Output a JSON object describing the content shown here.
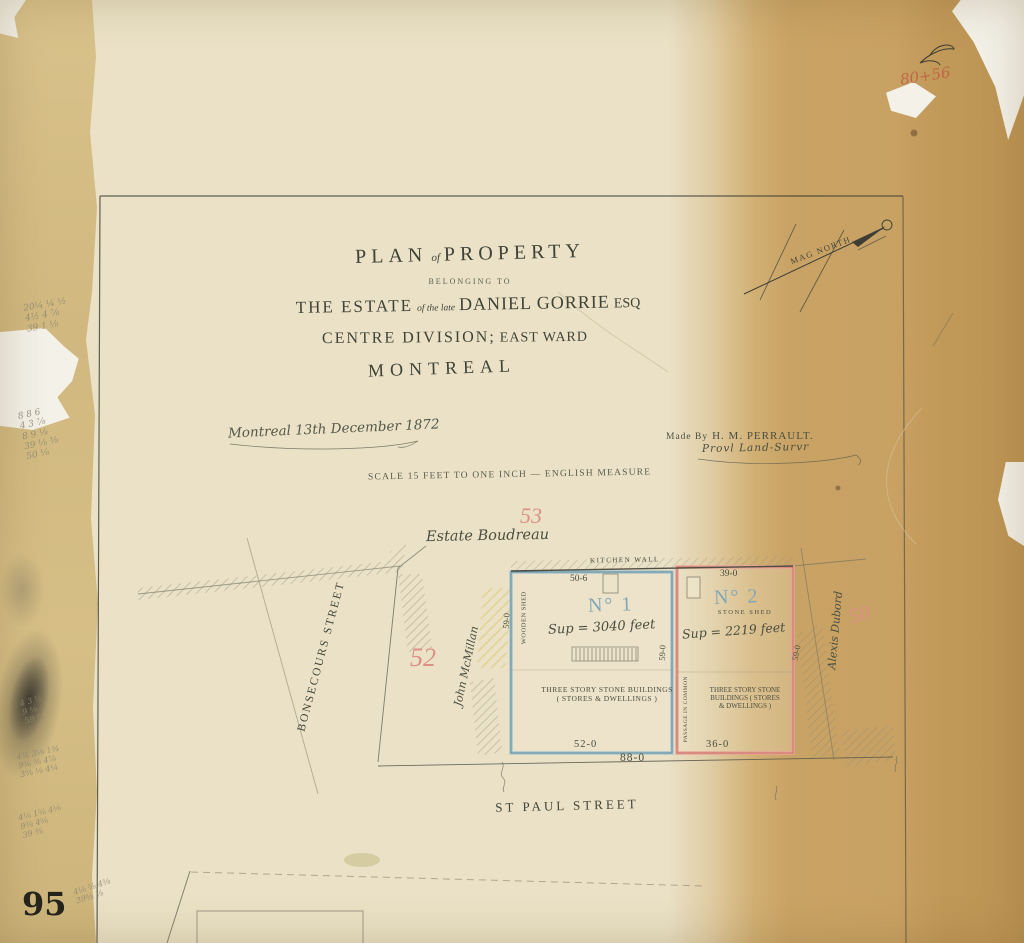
{
  "sheet": {
    "page_number": "95",
    "corner_notation": "80+56"
  },
  "colors": {
    "lot1_outline": "#92b7c0",
    "lot2_outline": "#e2988c",
    "cadastral_red": "#dc8f86",
    "ink": "#4a4e40",
    "paper_light": "#eae1c6",
    "paper_tan": "#c9a365"
  },
  "title_block": {
    "plan": "PLAN",
    "of": "of",
    "property": "PROPERTY",
    "belonging_to": "BELONGING TO",
    "the_estate": "THE ESTATE",
    "of_the_late": "of the late",
    "owner_name": "DANIEL GORRIE",
    "esq": "ESQ",
    "division": "CENTRE DIVISION;",
    "ward": "EAST WARD",
    "city": "MONTREAL"
  },
  "notes": {
    "date_line": "Montreal 13th December 1872",
    "made_by": "Made By",
    "surveyor_name": "H. M. PERRAULT.",
    "surveyor_title": "Provl Land-Survr",
    "scale_line": "SCALE 15 FEET TO ONE INCH — ENGLISH MEASURE",
    "north_label": "MAG NORTH"
  },
  "streets": {
    "west": "BONSECOURS STREET",
    "south": "ST PAUL STREET"
  },
  "neighbours": {
    "north_estate": "Estate Boudreau",
    "west_owner": "John McMillan",
    "east_owner": "Alexis Dubord"
  },
  "lot_numbers": {
    "north": "53",
    "west": "52",
    "east": "50"
  },
  "lot1": {
    "label": "N° 1",
    "area": "Sup = 3040 feet",
    "shed": "WOODEN SHED",
    "building": "THREE STORY STONE BUILDINGS\n( STORES & DWELLINGS )",
    "dim_top": "50-6",
    "dim_bottom": "52-0",
    "dim_side": "59-0"
  },
  "lot2": {
    "label": "N° 2",
    "sublabel": "STONE SHED",
    "area": "Sup = 2219 feet",
    "building": "THREE STORY STONE\nBUILDINGS ( STORES\n& DWELLINGS )",
    "dim_top": "39-0",
    "dim_bottom": "36-0",
    "dim_side": "59-0"
  },
  "boundary": {
    "kitchen_wall": "KITCHEN WALL",
    "passage": "PASSAGE IN COMMON",
    "dim_total_frontage": "88-0",
    "dim_mid": "59-0"
  },
  "pencil_notes": {
    "upper_left": "20¼ ¼ ½\n4½ 4 ⅞\n39 1 ⅛",
    "mid_left": "8 8 6\n4 3 ⅞\n8 9 ⅛\n39 ⅛ ⅜\n50 ⅛",
    "lower_left_a": "4 3 ½\n9 ⅛\n59 ½",
    "lower_left_b": "4¾ 3⅛ 1¾\n9⅜ ⅝ 4⅞\n3⅝ ⅛ 4¼",
    "lower_left_c": "4⅛ 1⅝ 4⅛\n9⅜ 4⅝\n39 ⅜",
    "bottom_left": "4⅛ ⅝ 4⅝\n39⅝ ⅛"
  }
}
